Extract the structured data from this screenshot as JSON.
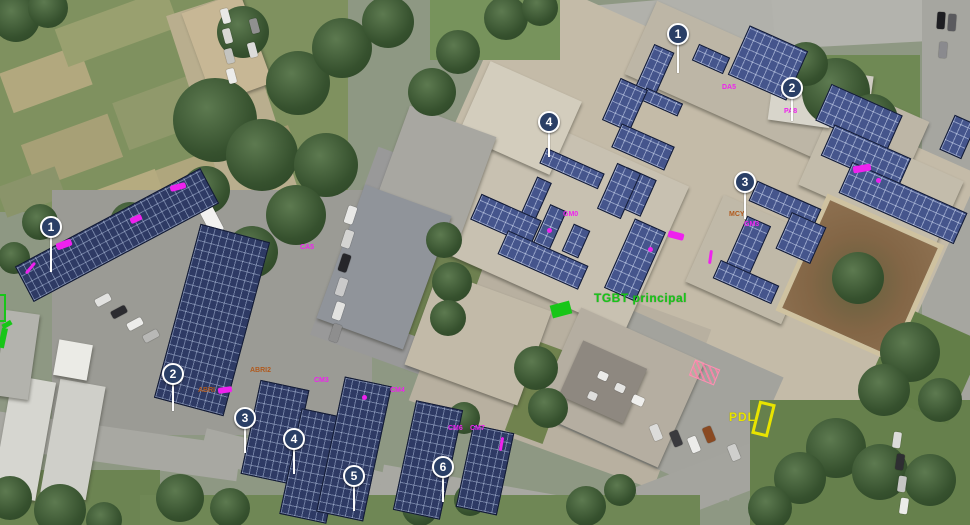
{
  "scene": {
    "description": "Aerial photovoltaic layout plan over a building campus with carport and rooftop PV arrays"
  },
  "colors": {
    "panel_carport": "#2e3a64",
    "panel_roof": "#45558c",
    "marker_bg": "#2a3f66",
    "magenta": "#ee22ee",
    "green": "#18c618",
    "yellow": "#e8e400",
    "orange": "#b05a1e"
  },
  "labels": {
    "tgbt": "TGBT principal",
    "pdl": "PDL"
  },
  "markers": {
    "carport": [
      {
        "num": "1",
        "x": 51,
        "y": 227,
        "stem": 36
      },
      {
        "num": "2",
        "x": 173,
        "y": 374,
        "stem": 28
      },
      {
        "num": "3",
        "x": 245,
        "y": 418,
        "stem": 26
      },
      {
        "num": "4",
        "x": 294,
        "y": 439,
        "stem": 26
      },
      {
        "num": "5",
        "x": 354,
        "y": 476,
        "stem": 26
      },
      {
        "num": "6",
        "x": 443,
        "y": 467,
        "stem": 26
      }
    ],
    "roof": [
      {
        "num": "1",
        "x": 678,
        "y": 34,
        "stem": 30
      },
      {
        "num": "2",
        "x": 792,
        "y": 88,
        "stem": 24
      },
      {
        "num": "3",
        "x": 745,
        "y": 182,
        "stem": 28
      },
      {
        "num": "4",
        "x": 549,
        "y": 122,
        "stem": 26
      }
    ]
  },
  "annotations": [
    {
      "x": 722,
      "y": 84,
      "kind": "text",
      "text": "DA5"
    },
    {
      "x": 784,
      "y": 108,
      "kind": "text",
      "text": "PA8"
    },
    {
      "x": 853,
      "y": 165,
      "kind": "blob",
      "w": 18,
      "h": 7,
      "rot": -10
    },
    {
      "x": 876,
      "y": 178,
      "kind": "dot"
    },
    {
      "x": 563,
      "y": 211,
      "kind": "text",
      "text": "GM0"
    },
    {
      "x": 547,
      "y": 228,
      "kind": "dot"
    },
    {
      "x": 648,
      "y": 247,
      "kind": "dot"
    },
    {
      "x": 744,
      "y": 221,
      "kind": "text",
      "text": "GM3"
    },
    {
      "x": 729,
      "y": 211,
      "kind": "text",
      "text": "MCY",
      "color": "#b05a1e"
    },
    {
      "x": 668,
      "y": 232,
      "kind": "blob",
      "w": 16,
      "h": 7,
      "rot": 15
    },
    {
      "x": 709,
      "y": 250,
      "kind": "vdash",
      "rot": 8
    },
    {
      "x": 170,
      "y": 184,
      "kind": "blob",
      "w": 16,
      "h": 6,
      "rot": -15
    },
    {
      "x": 56,
      "y": 241,
      "kind": "blob",
      "w": 16,
      "h": 7,
      "rot": -20
    },
    {
      "x": 130,
      "y": 216,
      "kind": "blob",
      "w": 12,
      "h": 6,
      "rot": -25
    },
    {
      "x": 29,
      "y": 261,
      "kind": "vdash",
      "rot": 40
    },
    {
      "x": 300,
      "y": 244,
      "kind": "text",
      "text": "CA5"
    },
    {
      "x": 250,
      "y": 367,
      "kind": "text",
      "text": "ABRI2",
      "color": "#b05a1e"
    },
    {
      "x": 198,
      "y": 387,
      "kind": "text",
      "text": "ABRI",
      "color": "#b05a1e"
    },
    {
      "x": 218,
      "y": 387,
      "kind": "blob",
      "w": 14,
      "h": 6,
      "rot": -8
    },
    {
      "x": 314,
      "y": 377,
      "kind": "text",
      "text": "CM3"
    },
    {
      "x": 390,
      "y": 387,
      "kind": "text",
      "text": "CM4"
    },
    {
      "x": 448,
      "y": 425,
      "kind": "text",
      "text": "CM6"
    },
    {
      "x": 470,
      "y": 425,
      "kind": "text",
      "text": "CM7"
    },
    {
      "x": 500,
      "y": 437,
      "kind": "vdash",
      "rot": 10
    },
    {
      "x": 362,
      "y": 395,
      "kind": "dot"
    }
  ]
}
